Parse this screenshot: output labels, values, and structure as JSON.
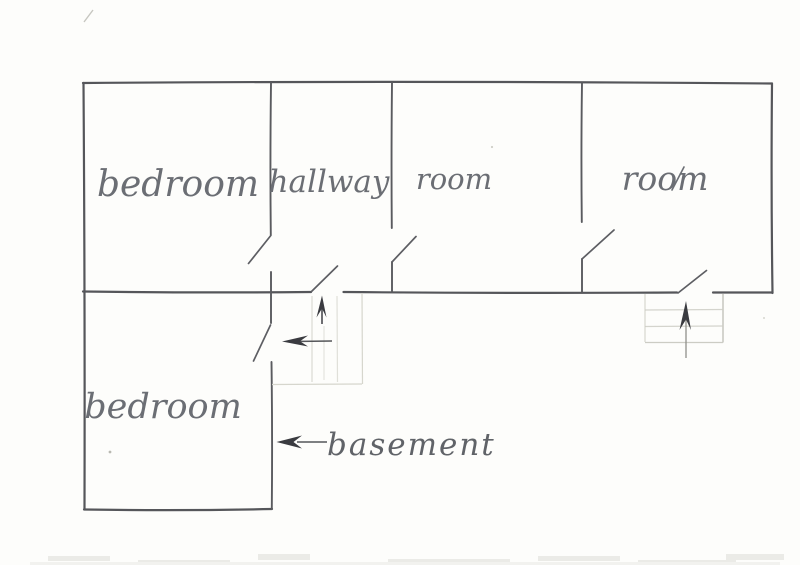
{
  "plan": {
    "kind": "hand-drawn floor plan sketch",
    "rooms": [
      {
        "id": "bedroom-top",
        "label": "bedroom"
      },
      {
        "id": "hallway",
        "label": "hallway"
      },
      {
        "id": "room-1",
        "label": "room"
      },
      {
        "id": "room-2",
        "label": "room"
      },
      {
        "id": "bedroom-lower",
        "label": "bedroom"
      }
    ],
    "annotations": {
      "basement": "basement"
    },
    "icons": [
      {
        "name": "up-arrow-icon-hallway-stairs",
        "meaning": "stairs direction up"
      },
      {
        "name": "left-arrow-icon-hallway-stairs",
        "meaning": "stairs direction left"
      },
      {
        "name": "up-arrow-icon-right-stairs",
        "meaning": "stairs direction up"
      },
      {
        "name": "left-arrow-icon-basement",
        "meaning": "points to basement wall"
      }
    ],
    "colors": {
      "paper": "#fdfdfb",
      "pencil_wall": "#55565a",
      "pencil_door": "#5d5e63",
      "pencil_text": "#6b6e74",
      "pencil_faint": "#d6d6cd",
      "arrow_dark": "#3a3b40"
    }
  }
}
